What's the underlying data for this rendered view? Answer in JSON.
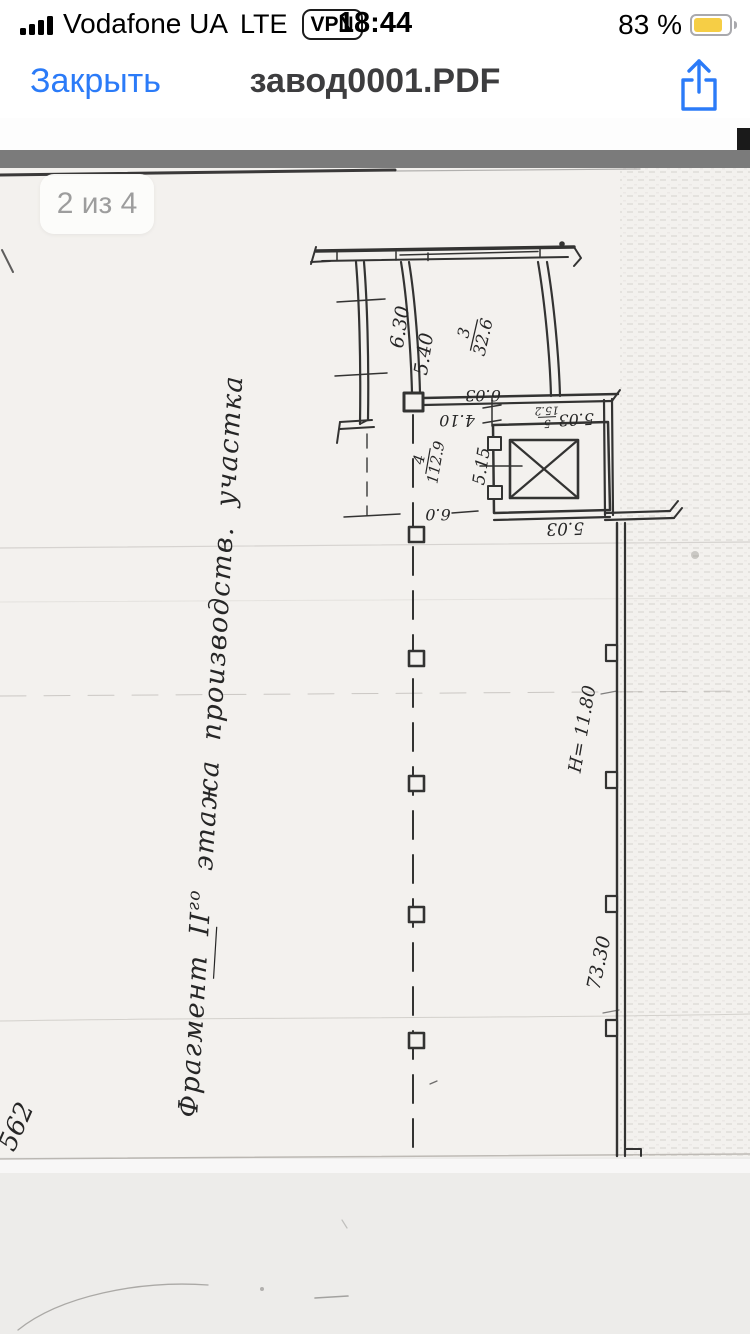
{
  "status_bar": {
    "carrier": "Vodafone UA",
    "network": "LTE",
    "vpn_label": "VPN",
    "time": "18:44",
    "battery_percent": "83 %",
    "battery_color": "#f6ce45"
  },
  "nav_bar": {
    "close_label": "Закрыть",
    "title": "завод0001.PDF",
    "accent_color": "#2b7bf8"
  },
  "viewer": {
    "page_indicator": "2 из 4"
  },
  "drawing": {
    "annotation": {
      "part1": "Фрагмент II",
      "sup": "го",
      "part2": " этажа производств. участка"
    },
    "sheet_number": "562",
    "rooms": {
      "room3": {
        "num": "3",
        "den": "32.6"
      },
      "room4": {
        "num": "4",
        "den": "112.9"
      },
      "room5": {
        "num": "5",
        "den": "15.2"
      }
    },
    "dims": {
      "d630": "6.30",
      "d540": "5.40",
      "d603": "6.03",
      "d410": "4.10",
      "d503_top": "5.03",
      "d515": "5.15",
      "d60": "6.0",
      "d503_bottom": "5.03",
      "height_mark": "Н= 11.80",
      "d7330": "73.30"
    }
  }
}
